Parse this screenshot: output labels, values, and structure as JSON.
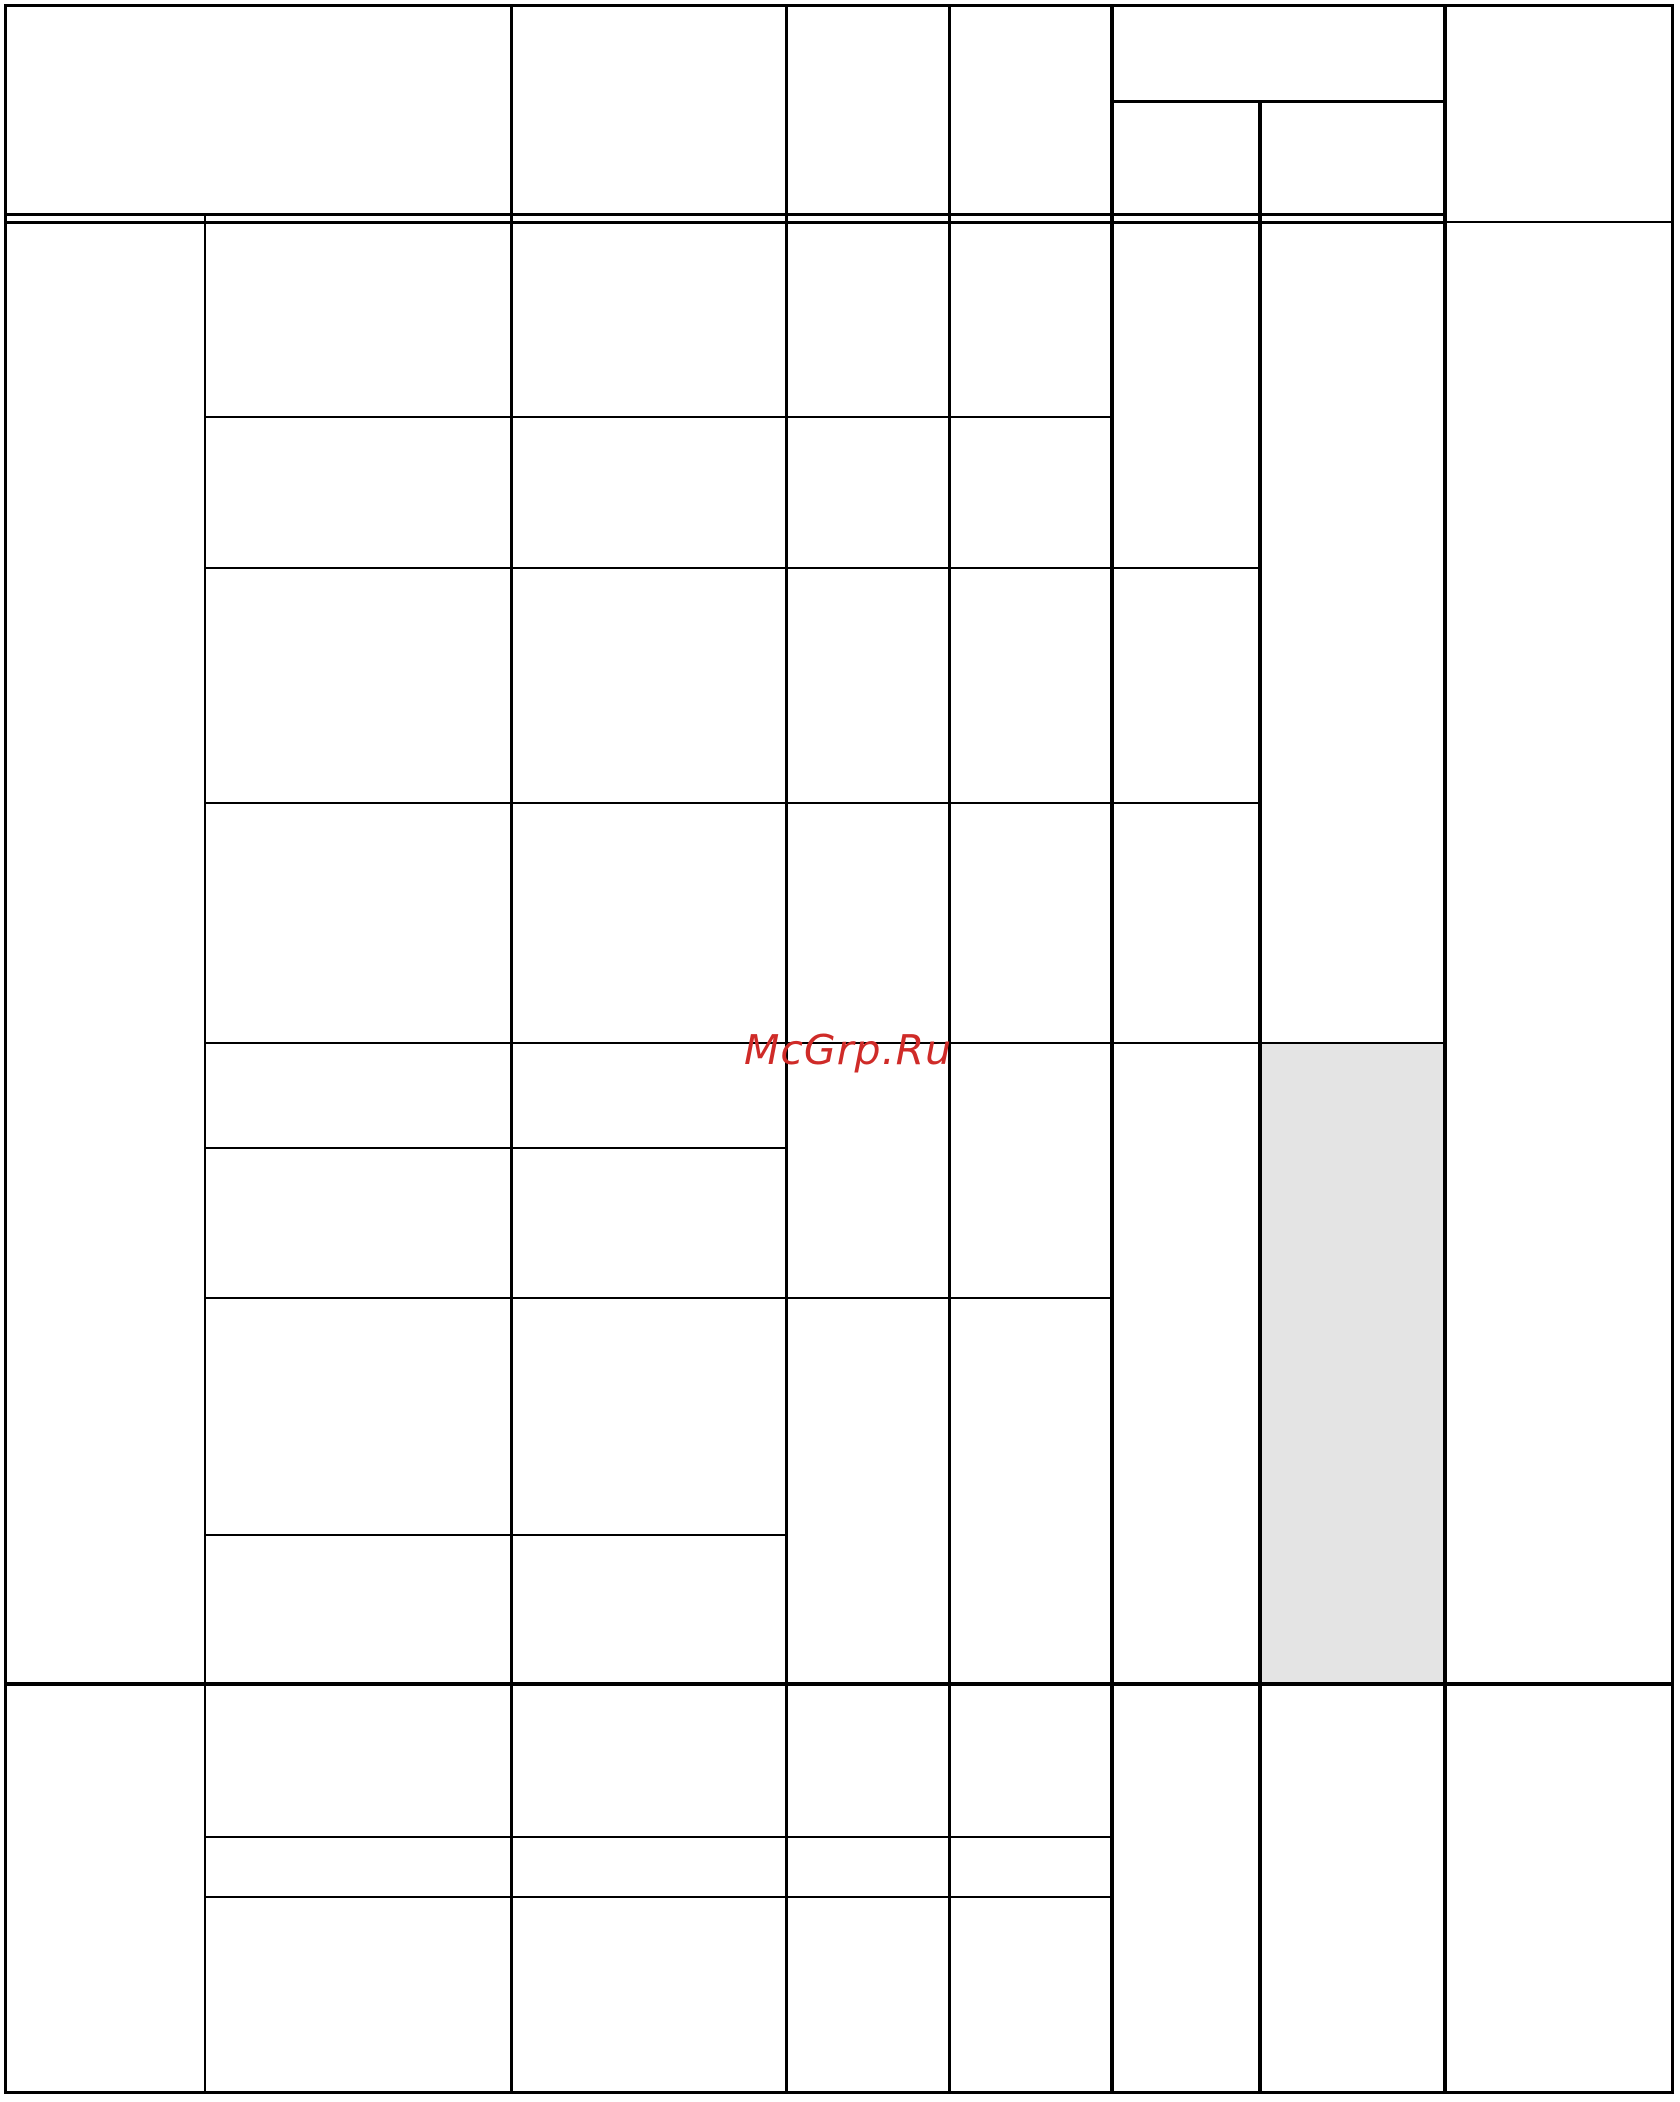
{
  "watermark": {
    "text": "McGrp.Ru",
    "color": "#cf2b28"
  },
  "colors": {
    "background": "#ffffff",
    "grid_line": "#000000",
    "shaded_cell": "#e4e4e4"
  },
  "table": {
    "description": "empty ruled table grid, no cell text visible",
    "header": {
      "row_count": 1,
      "column_count": 6,
      "split_column_subcells": 2
    },
    "body": {
      "sections": 2,
      "column_count": 8,
      "shaded_cells": 1
    },
    "cell_text": ""
  }
}
